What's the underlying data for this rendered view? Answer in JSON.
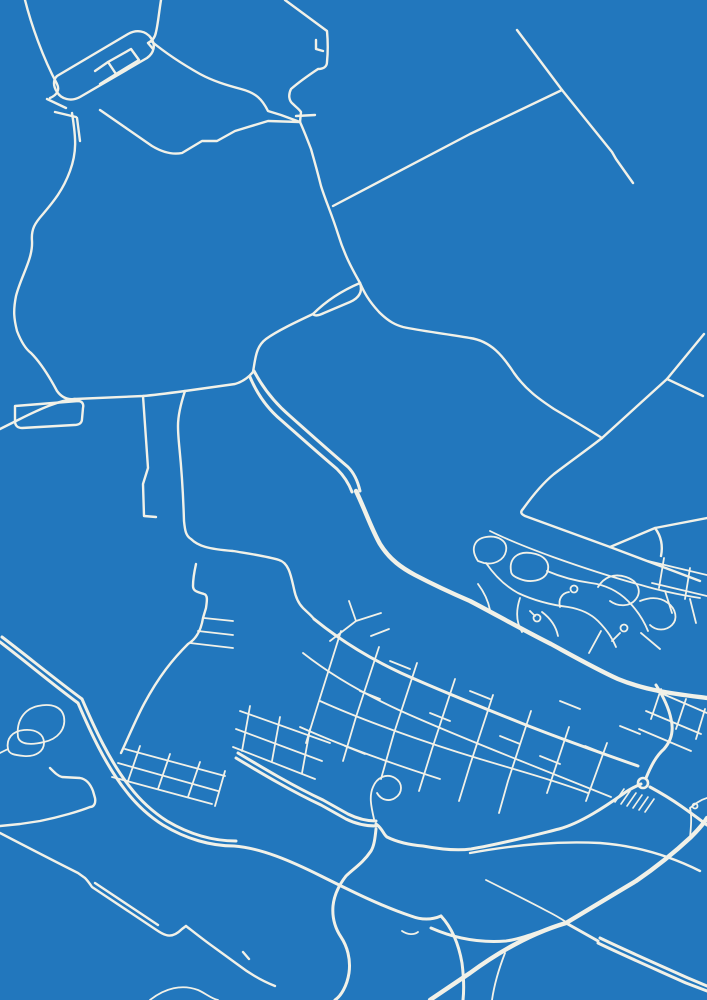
{
  "map": {
    "kind": "blueprint-style street map poster",
    "background_color": "#2277BD",
    "road_color": "#F1F1E8",
    "canvas": {
      "width": 707,
      "height": 1000
    },
    "layers": [
      {
        "name": "rural-roads",
        "width": 2.4,
        "paths": [
          "M25,0 C31,24 43,58 57,84 C60,90 57,95 50,98",
          "M57,76 L128,34 C137,29 146,31 151,38 C156,45 154,53 147,58 L80,97 C71,102 61,99 57,92 C53,86 53,80 57,76 Z",
          "M108,62 L131,49 L139,60 L116,74 Z",
          "M95,71 L108,62 M116,74 L100,84",
          "M161,0 C159,12 158,24 156,32 C155,38 152,41 148,43 M148,43 L153,49",
          "M151,41 C168,55 184,65 200,74 C213,81 226,85 241,89 C256,93 262,99 268,111 L281,115 L300,122",
          "M100,110 L152,146 C162,152 172,155 182,153 L202,141 L217,141 L235,131 L268,121 L300,122",
          "M47,99 L66,108 M55,112 L76,117",
          "M77,118 L80,141",
          "M72,113 C76,138 77,152 70,171 C63,190 54,201 43,214 C35,223 31,229 32,241 C33,259 21,276 16,296 C13,311 14,319 17,331 C22,344 27,350 31,353 C41,363 49,376 57,391 C62,398 68,400 75,399",
          "M285,0 L327,31 C328,42 328,52 327,62 C327,67 323,69 318,69 C309,75 299,82 291,89 C288,95 289,101 293,104 C296,107 299,109 301,112 L300,122",
          "M316,40 L316,49 L323,51",
          "M296,116 L315,115",
          "M300,122 C305,133 309,144 311,149 C315,163 318,174 321,186 C326,202 331,212 338,234 C345,257 354,272 360,283",
          "M333,206 L470,134 L562,90",
          "M517,30 L562,90 L612,152 L616,159 L633,183",
          "M360,283 C341,291 326,301 313,314",
          "M360,283 C363,292 359,298 350,302 L324,313 C318,316 314,316 313,314",
          "M313,314 C296,322 277,331 266,339 C258,345 256,353 254,366 L253,372",
          "M360,283 C364,292 368,300 379,312 C389,322 396,325 403,327 C421,331 441,333 470,338 C491,341 503,356 514,373 C526,390 539,399 554,409 C571,419 586,428 602,438",
          "M253,372 C248,378 242,382 235,384 L185,391 C170,393 155,395 143,396 L75,399 C60,400 40,409 20,419 L0,429",
          "M15,406 L78,401 C82,401 84,404 83,408 L82,419 C82,423 79,425 74,425 L22,428 C17,428 15,425 15,421 Z",
          "M143,396 L148,468 L143,484 L144,516 L156,517",
          "M185,391 C180,406 178,416 178,426 C178,446 182,456 184,521 C185,531 186,536 191,539 C198,546 208,549 233,551 C251,554 266,556 279,560 C289,563 291,576 294,589 C296,599 299,604 303,608 C307,612 311,615 314,619",
          "M602,438 C588,449 571,461 554,474 C543,483 533,495 523,509 C520,512 521,514 525,516 L610,547 L700,581",
          "M610,547 L655,528 L707,518",
          "M655,528 C661,536 663,546 661,556",
          "M667,379 L703,396",
          "M602,438 L667,379 L704,334",
          "M196,564 C194,573 193,579 193,586 C193,591 197,592 204,594 C208,595 207,601 206,608 L203,618 C201,631 196,639 188,644 C173,659 159,676 144,704 C136,719 129,736 121,753",
          "M50,768 C55,773 58,776 62,777 L80,778 C86,779 90,783 93,791 L95,798 C96,803 94,807 90,807 C80,811 60,817 40,821 L20,824 L0,826",
          "M0,833 C25,846 50,859 78,873 L85,878 C88,881 90,884 92,887 L155,929 C158,931 162,934 166,935 C172,937 178,933 182,929 L186,926",
          "M95,883 L158,925",
          "M186,926 C195,933 205,941 215,948 L237,964 C250,974 262,981 275,986 M243,952 L249,959",
          "M470,853 C520,844 560,841 600,843 C640,846 672,857 700,871"
        ]
      },
      {
        "name": "highways",
        "width": 4.4,
        "paths": [
          "M356,491 C366,512 371,528 380,544 C390,560 402,568 415,575 C438,587 456,595 470,601 C495,614 521,629 551,644 C573,656 596,669 618,679 C647,691 676,694 707,698",
          "M430,1000 L470,973 C500,951 532,933 566,923 L636,881 C655,868 676,851 691,837 C699,829 704,823 707,818"
        ]
      },
      {
        "name": "secondary-roads",
        "width": 3,
        "paths": [
          "M254,371 C264,390 276,404 290,416 C308,432 328,450 348,467 C355,474 358,482 360,491",
          "M250,377 C258,396 268,409 281,420 C298,435 318,453 337,469 C344,476 349,484 352,492",
          "M0,642 C25,661 51,683 78,703 C90,731 106,766 126,791 C136,804 149,816 163,825 C186,839 211,846 234,846 C261,848 291,861 321,876 C351,891 381,906 411,916 C424,921 434,919 441,916",
          "M2,637 C27,656 55,679 82,699 C94,727 110,762 130,787 C140,800 153,812 167,821 C189,834 213,841 236,841",
          "M236,758 C261,773 291,791 321,805 L346,819 C356,824 366,826 376,826",
          "M238,753 C263,768 293,786 323,800 L348,814 C358,819 367,821 376,821",
          "M376,824 C383,829 383,834 387,837 C399,843 411,845 423,846 C439,849 456,851 471,849 C501,844 531,836 559,829 C581,823 606,806 623,794 C631,788 637,786 641,784",
          "M646,778 C651,766 656,756 664,749 C671,741 674,731 671,719 C669,709 663,696 656,685",
          "M650,787 C661,793 671,799 681,806 C691,813 699,819 707,825",
          "M376,829 C375,839 374,846 371,851 C363,863 353,869 346,876 C339,885 334,896 333,906 C332,918 335,928 341,937 C347,946 351,959 349,973 C347,986 341,996 335,1000",
          "M441,916 C453,929 459,946 462,963 C464,979 464,991 463,1000",
          "M431,928 C456,939 481,943 506,941 C521,939 541,931 556,926",
          "M598,943 C625,956 655,969 686,983 L707,991",
          "M600,938 C627,951 657,964 688,978 L707,986",
          "M566,923 L598,941",
          "M314,619 C341,641 371,659 401,673 C441,691 481,707 521,723 C561,739 601,753 638,766"
        ]
      },
      {
        "name": "residential-streets",
        "width": 1.8,
        "paths": [
          "M490,531 C510,541 531,549 553,557 C581,567 611,577 641,585 C661,591 681,595 700,598",
          "M478,561 C470,549 474,539 486,537 C498,535 508,541 506,551 C504,561 493,565 484,563 Z",
          "M511,571 C509,559 517,551 531,553 C545,555 551,563 547,573 C543,581 530,583 520,579 C515,577 511,575 511,571 Z",
          "M486,563 C495,576 505,586 518,593 C535,601 552,605 568,607 C580,609 590,613 598,621 C606,629 612,637 616,647",
          "M547,571 C561,577 576,581 591,583 C606,585 618,591 628,601 C638,611 644,621 648,631",
          "M598,587 C604,577 614,573 626,577 C638,581 642,591 636,599 C630,607 618,607 610,601",
          "M560,607 C558,599 562,593 569,592",
          "M612,641 L620,633",
          "M640,601 C650,597 660,597 668,603 C676,609 678,619 672,625 C666,631 656,631 650,625",
          "M665,591 L672,613 M690,599 L696,623 M641,633 L660,649 M601,631 L589,653",
          "M330,641 L356,621 L381,613 M356,621 L349,601 M371,636 L389,629",
          "M320,701 C360,719 420,741 480,759 C520,771 556,781 588,793",
          "M300,727 C340,745 390,763 440,779",
          "M303,653 C331,675 366,695 401,711 C441,729 481,745 521,761 C551,773 581,785 611,797",
          "M341,631 L319,701 L306,743",
          "M379,647 L356,717 L343,761",
          "M417,663 L394,733 L381,779",
          "M455,679 L432,749 L419,791",
          "M493,695 L470,765 L459,801",
          "M531,711 L508,781 L499,813",
          "M569,727 L547,793",
          "M607,743 L586,801",
          "M656,691 L707,713 M646,711 L701,734 M639,729 L691,751 M661,689 L651,719 M686,699 L676,729 M705,709 L696,739",
          "M240,711 L330,743 M236,729 L322,761 M233,747 L315,779 M250,706 L242,751 M280,717 L272,761 M310,729 L302,773",
          "M374,819 C371,806 369,796 373,787 C377,777 387,773 395,778 C403,783 403,793 395,798 C389,802 381,800 377,793",
          "M204,618 L233,621 M198,631 L233,635 M190,643 L233,648",
          "M125,749 L225,776 M118,763 L218,791 M112,777 L212,804 M140,746 L128,781 M170,754 L158,789 M200,762 L188,797 M225,771 L215,806",
          "M18,737 C16,721 24,709 38,706 C52,703 62,707 64,717 C66,729 58,739 44,742 C32,745 20,745 18,737 Z",
          "M8,749 C6,739 12,731 24,730 C36,729 44,734 44,743 C44,751 36,757 24,756 C14,755 9,754 8,749 Z",
          "M0,753 L8,749",
          "M690,808 C695,804 700,800 707,798 M690,808 C692,816 691,827 690,838",
          "M486,880 C506,890 526,900 545,910 C553,914 560,918 566,922",
          "M402,931 C408,935 414,935 418,932",
          "M150,1000 C165,988 182,984 198,990 C205,993 212,999 218,1000",
          "M505,953 C498,971 494,986 492,1000",
          "M648,561 L707,575 M652,583 L707,596 M664,558 L659,588 M690,568 L685,599",
          "M360,691 L380,699 M430,713 L450,721 M500,736 L520,744 M470,691 L490,699 M540,756 L560,764 M390,661 L410,669 M560,701 L580,709 M345,746 L365,754 M585,746 L605,754 M620,726 L640,734",
          "M520,598 C516,610 516,622 522,632 M542,612 C550,618 556,626 558,636 M478,584 C484,592 488,600 490,610",
          "M530,611 L535,616"
        ]
      },
      {
        "name": "service-ticks",
        "width": 1.6,
        "paths": [
          "M624,789 L615,802 M630,791 L621,804 M636,793 L627,806 M642,795 L633,808 M648,797 L639,810 M654,799 L645,812"
        ]
      }
    ],
    "circles": [
      {
        "name": "roundabout-circle",
        "cx": 643,
        "cy": 783,
        "r": 5,
        "width": 2.6
      },
      {
        "name": "cul-de-sac-circle",
        "cx": 574,
        "cy": 589,
        "r": 3.5,
        "width": 1.8
      },
      {
        "name": "cul-de-sac-circle",
        "cx": 624,
        "cy": 628,
        "r": 3.5,
        "width": 1.8
      },
      {
        "name": "cul-de-sac-circle",
        "cx": 537,
        "cy": 618,
        "r": 3.5,
        "width": 1.8
      },
      {
        "name": "cul-de-sac-circle",
        "cx": 695,
        "cy": 806,
        "r": 2.5,
        "width": 1.8
      }
    ]
  }
}
